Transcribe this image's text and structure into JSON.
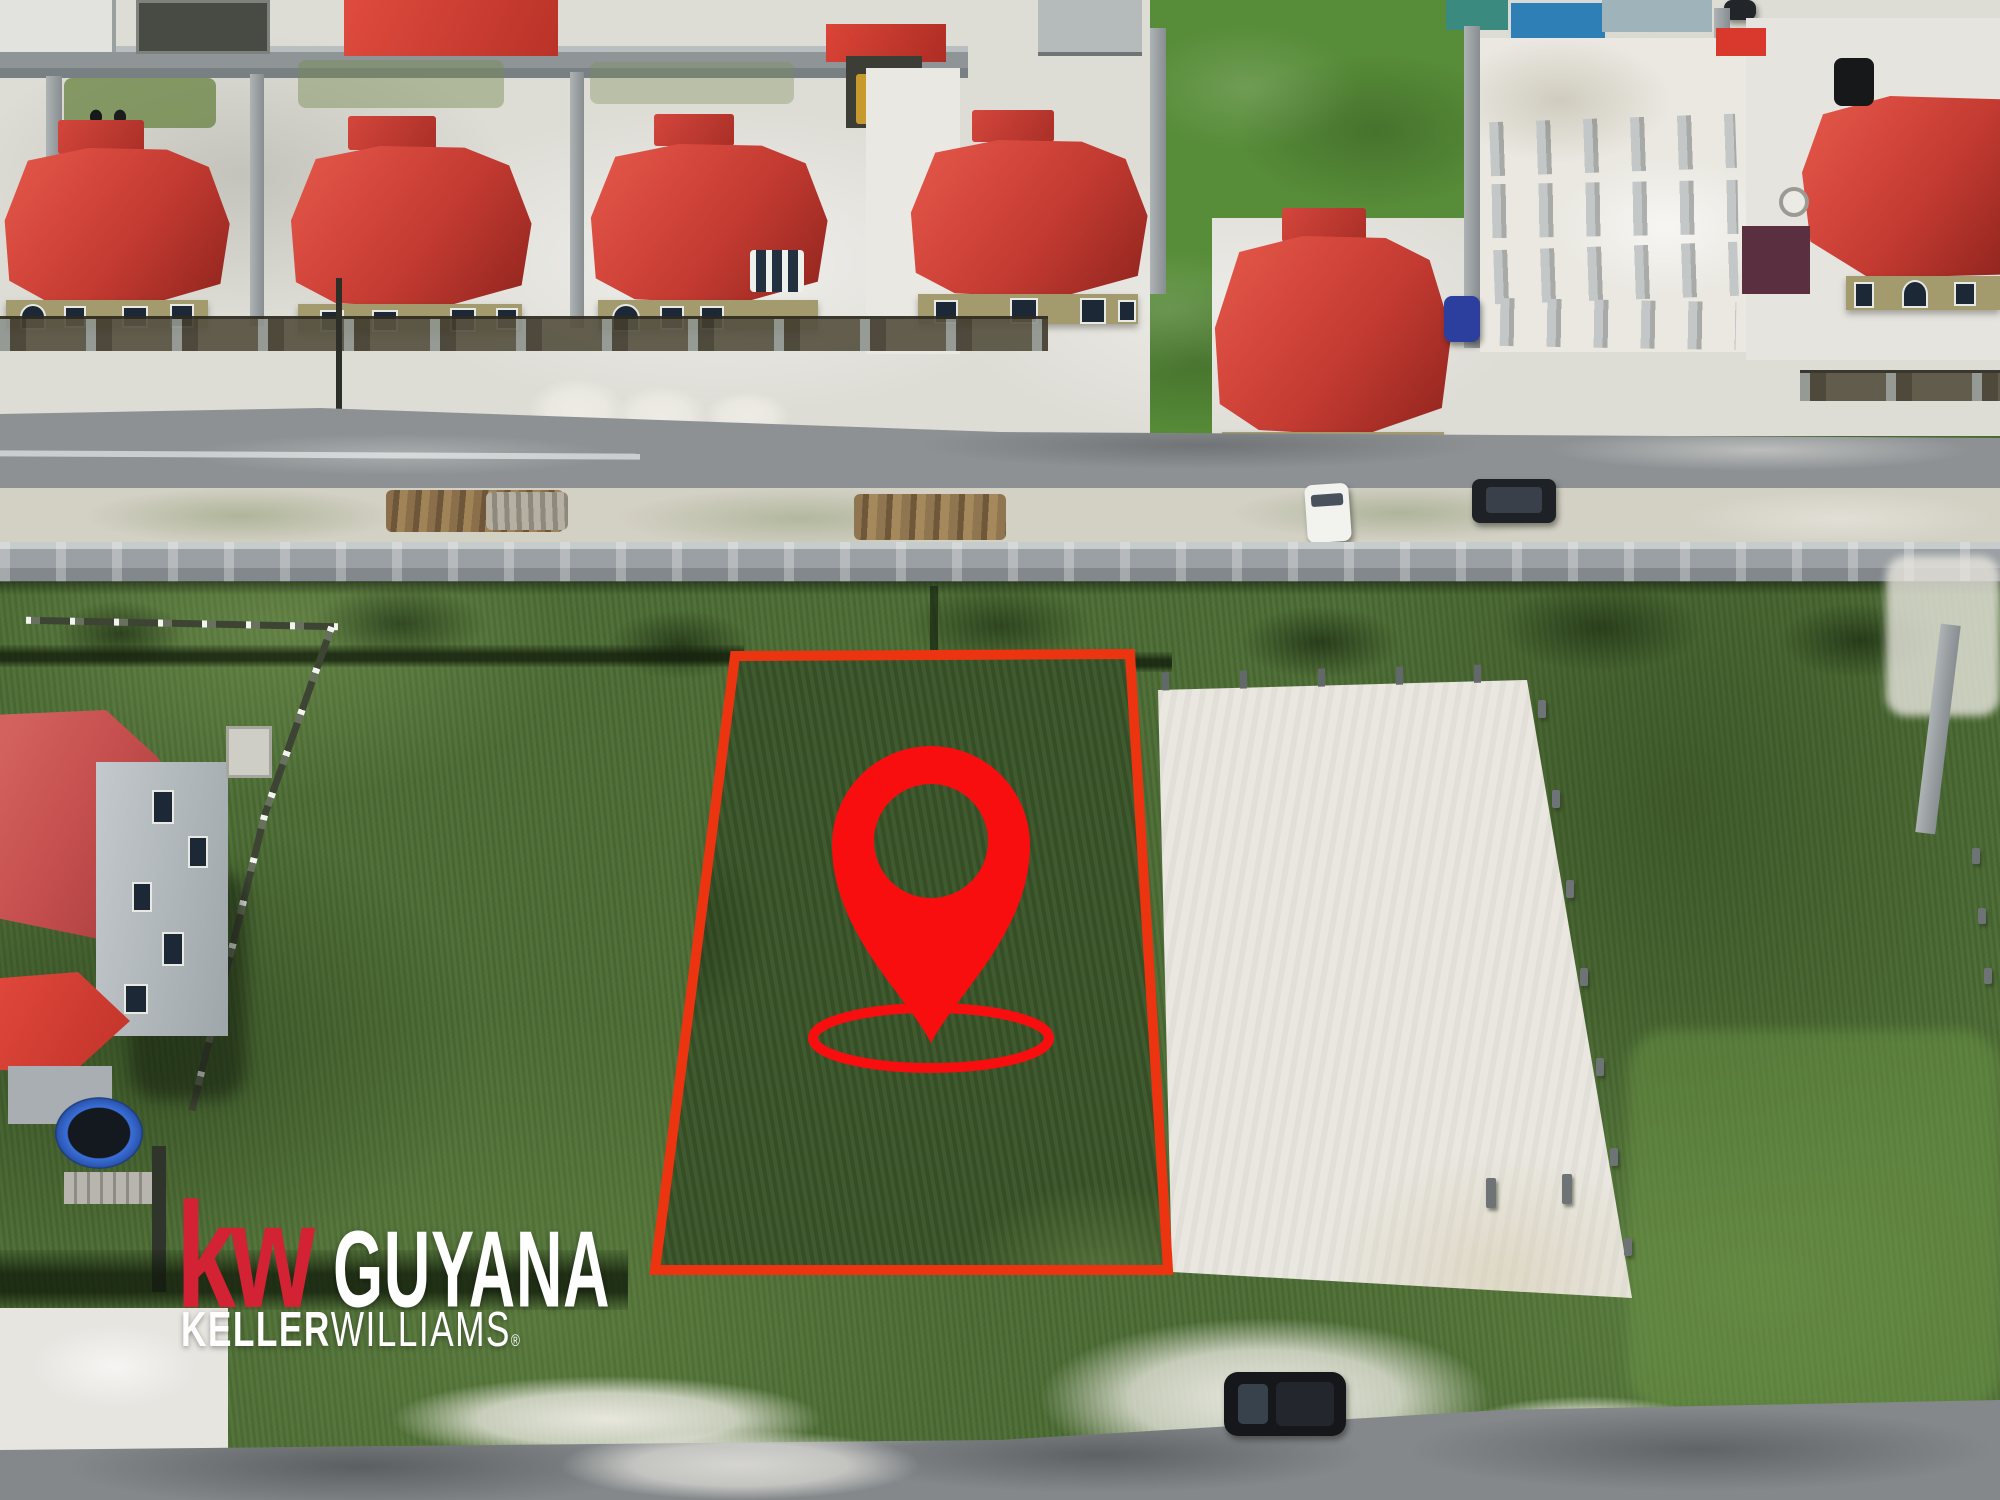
{
  "watermark": {
    "kw": "kw",
    "region": "GUYANA",
    "brand_bold": "KELLER",
    "brand_light": "WILLIAMS",
    "registered": "®",
    "kw_color": "#d32233",
    "text_color": "#ffffff"
  },
  "map_overlay": {
    "pin_icon": "location-pin-icon",
    "pin_color": "#f80e0e",
    "boundary_name": "highlighted-lot-boundary",
    "boundary_color": "#ec3410"
  },
  "scene": {
    "type": "aerial-drone-photograph",
    "features": [
      "red-roof-houses-row",
      "asphalt-road",
      "boundary-wall",
      "vacant-grassy-lot",
      "cleared-sand-lot",
      "construction-pillars",
      "parked-cars",
      "left-house-compound",
      "trampoline",
      "bottom-road",
      "drainage-ditch"
    ]
  }
}
